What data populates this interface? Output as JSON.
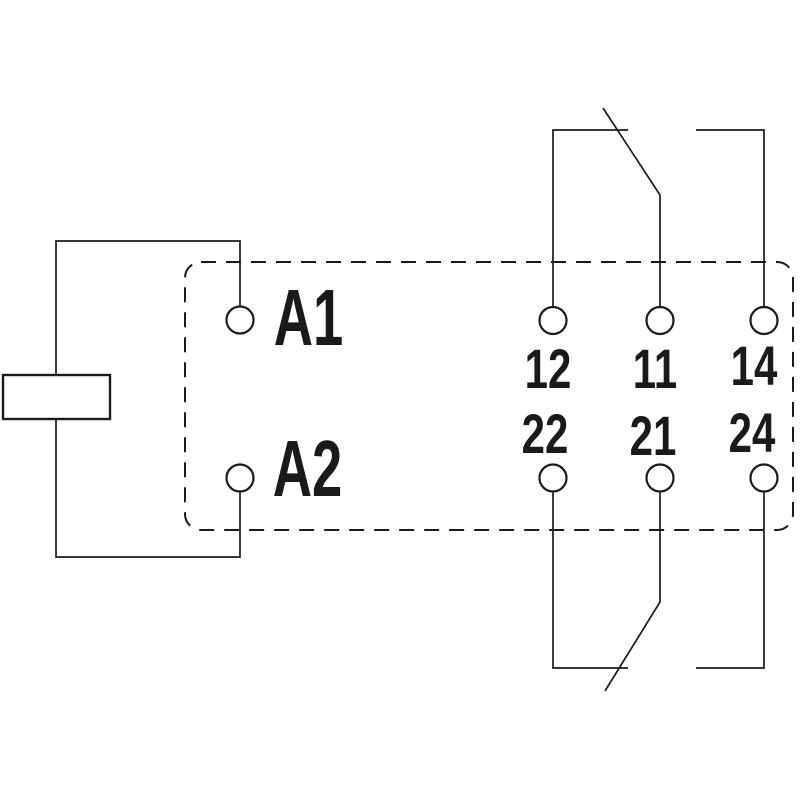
{
  "diagram": {
    "kind": "relay-wiring-schematic",
    "background": "#ffffff",
    "line_color": "#1a1a1a",
    "coil": {
      "a1": "A1",
      "a2": "A2"
    },
    "pole1": {
      "nc": "12",
      "com": "11",
      "no": "14"
    },
    "pole2": {
      "nc": "22",
      "com": "21",
      "no": "24"
    }
  }
}
